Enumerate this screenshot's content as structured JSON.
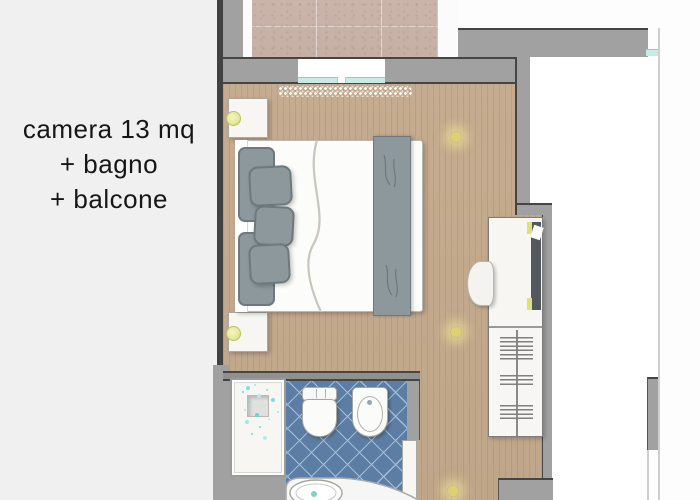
{
  "sidebar": {
    "line1": "camera 13 mq",
    "line2": "+ bagno",
    "line3": "+ balcone"
  },
  "palette": {
    "page_bg": "#fdfdfd",
    "panel_bg": "#f0f0f1",
    "text_color": "#161616",
    "wall_gray": "#a1a1a1",
    "wall_outline": "#454545",
    "wood_floor": "#c5ab8f",
    "balcony_stone": "#cab4a9",
    "tile_blue": "#5d7ea4",
    "tile_line": "#a7bcd4",
    "glass_teal": "#c8ebe7",
    "glass_edge": "#7fd3c9",
    "fabric_gray": "#8d989c",
    "fabric_edge": "#6e797d",
    "fixture_white": "#f7f6f2",
    "fixture_edge": "#a9a9a4",
    "lamp_yellow": "#e4e79b",
    "light_glow": "#decf6f",
    "accent_green": "#dce37a",
    "mirror_dark": "#52585e"
  }
}
